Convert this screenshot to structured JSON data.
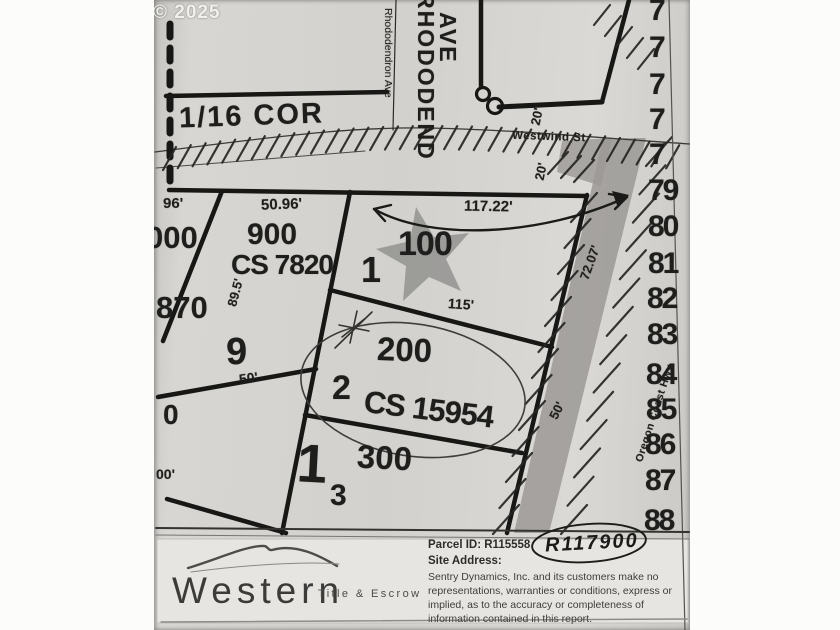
{
  "watermark": "© 2025",
  "map": {
    "corner_label": "1/16 COR",
    "streets": {
      "rhododendron_small": "Rhododendron Ave",
      "rhododendron_big_line1": "RHODODEND",
      "rhododendron_big_line2": "AVE",
      "westwind": "Westwind St",
      "oregon_coast_hwy": "Oregon Coast Hwy"
    },
    "parcels": {
      "p000": "000",
      "p900": "900",
      "p900_cs": "CS 7820",
      "p870": "870",
      "p100": "100",
      "p200": "200",
      "p200_cs": "CS 15954",
      "p300": "300",
      "p0": "0",
      "lot1": "1",
      "lot2": "2",
      "lot9": "9",
      "lot1b": "1",
      "lot3": "3"
    },
    "dimensions": {
      "d96": "96'",
      "d50_96": "50.96'",
      "d117_22": "117.22'",
      "d115": "115'",
      "d72_07": "72.07'",
      "d89_5": "89.5'",
      "d50_lot9": "50'",
      "d50_hwy": "50'",
      "d20_north": "20'",
      "d20_south": "20'",
      "d00": "00'"
    },
    "right_numbers": [
      "7",
      "7",
      "7",
      "7",
      "7",
      "79",
      "80",
      "81",
      "82",
      "83",
      "84",
      "85",
      "86",
      "87",
      "88"
    ],
    "annotation": "R117900"
  },
  "footer": {
    "logo_main": "Western",
    "logo_sub": "Title & Escrow",
    "parcel_id_label": "Parcel ID: R115558",
    "site_address_label": "Site Address:",
    "disclaimer": "Sentry Dynamics, Inc. and its customers make no representations, warranties or conditions, express or implied, as to the accuracy or completeness of information contained in this report."
  },
  "colors": {
    "paper": "#d5d3cf",
    "ink": "#171715",
    "highway_band": "#9b9995",
    "footer_paper": "#e7e5e1"
  }
}
